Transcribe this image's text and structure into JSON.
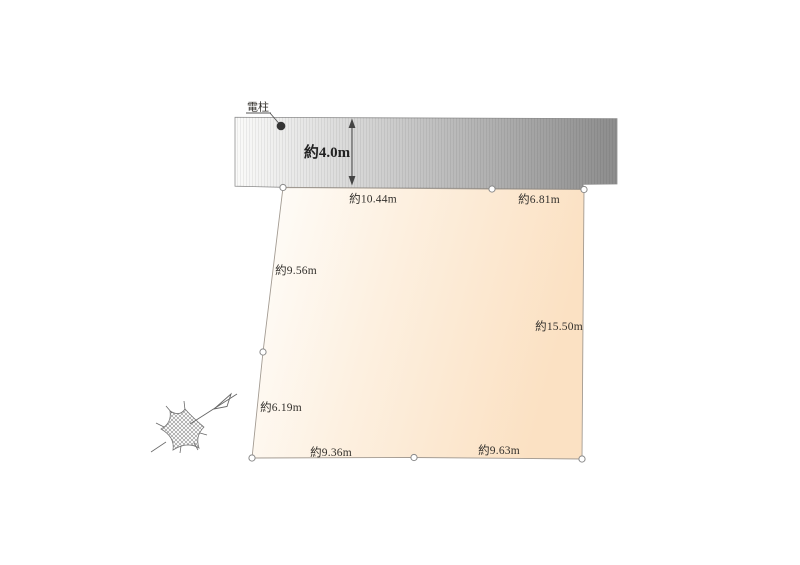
{
  "diagram": {
    "title": "land-plot-site-diagram",
    "pole": {
      "label": "電柱"
    },
    "road": {
      "width_label": "約4.0m",
      "fill_start": "#fbfbfa",
      "fill_mid": "#c2c2c2",
      "fill_end": "#8d8d8d",
      "edge_color": "#8f8f8f"
    },
    "parcel": {
      "fill_start": "#fefefc",
      "fill_mid": "#fdf0e0",
      "fill_end": "#fbe1c3",
      "edge_color": "#a39b92",
      "dims": {
        "top_a": "約10.44m",
        "top_b": "約6.81m",
        "left_a": "約9.56m",
        "left_b": "約6.19m",
        "right_a": "約15.50m",
        "bottom_a": "約9.36m",
        "bottom_b": "約9.63m"
      }
    },
    "compass": {
      "name": "north-arrow"
    }
  }
}
